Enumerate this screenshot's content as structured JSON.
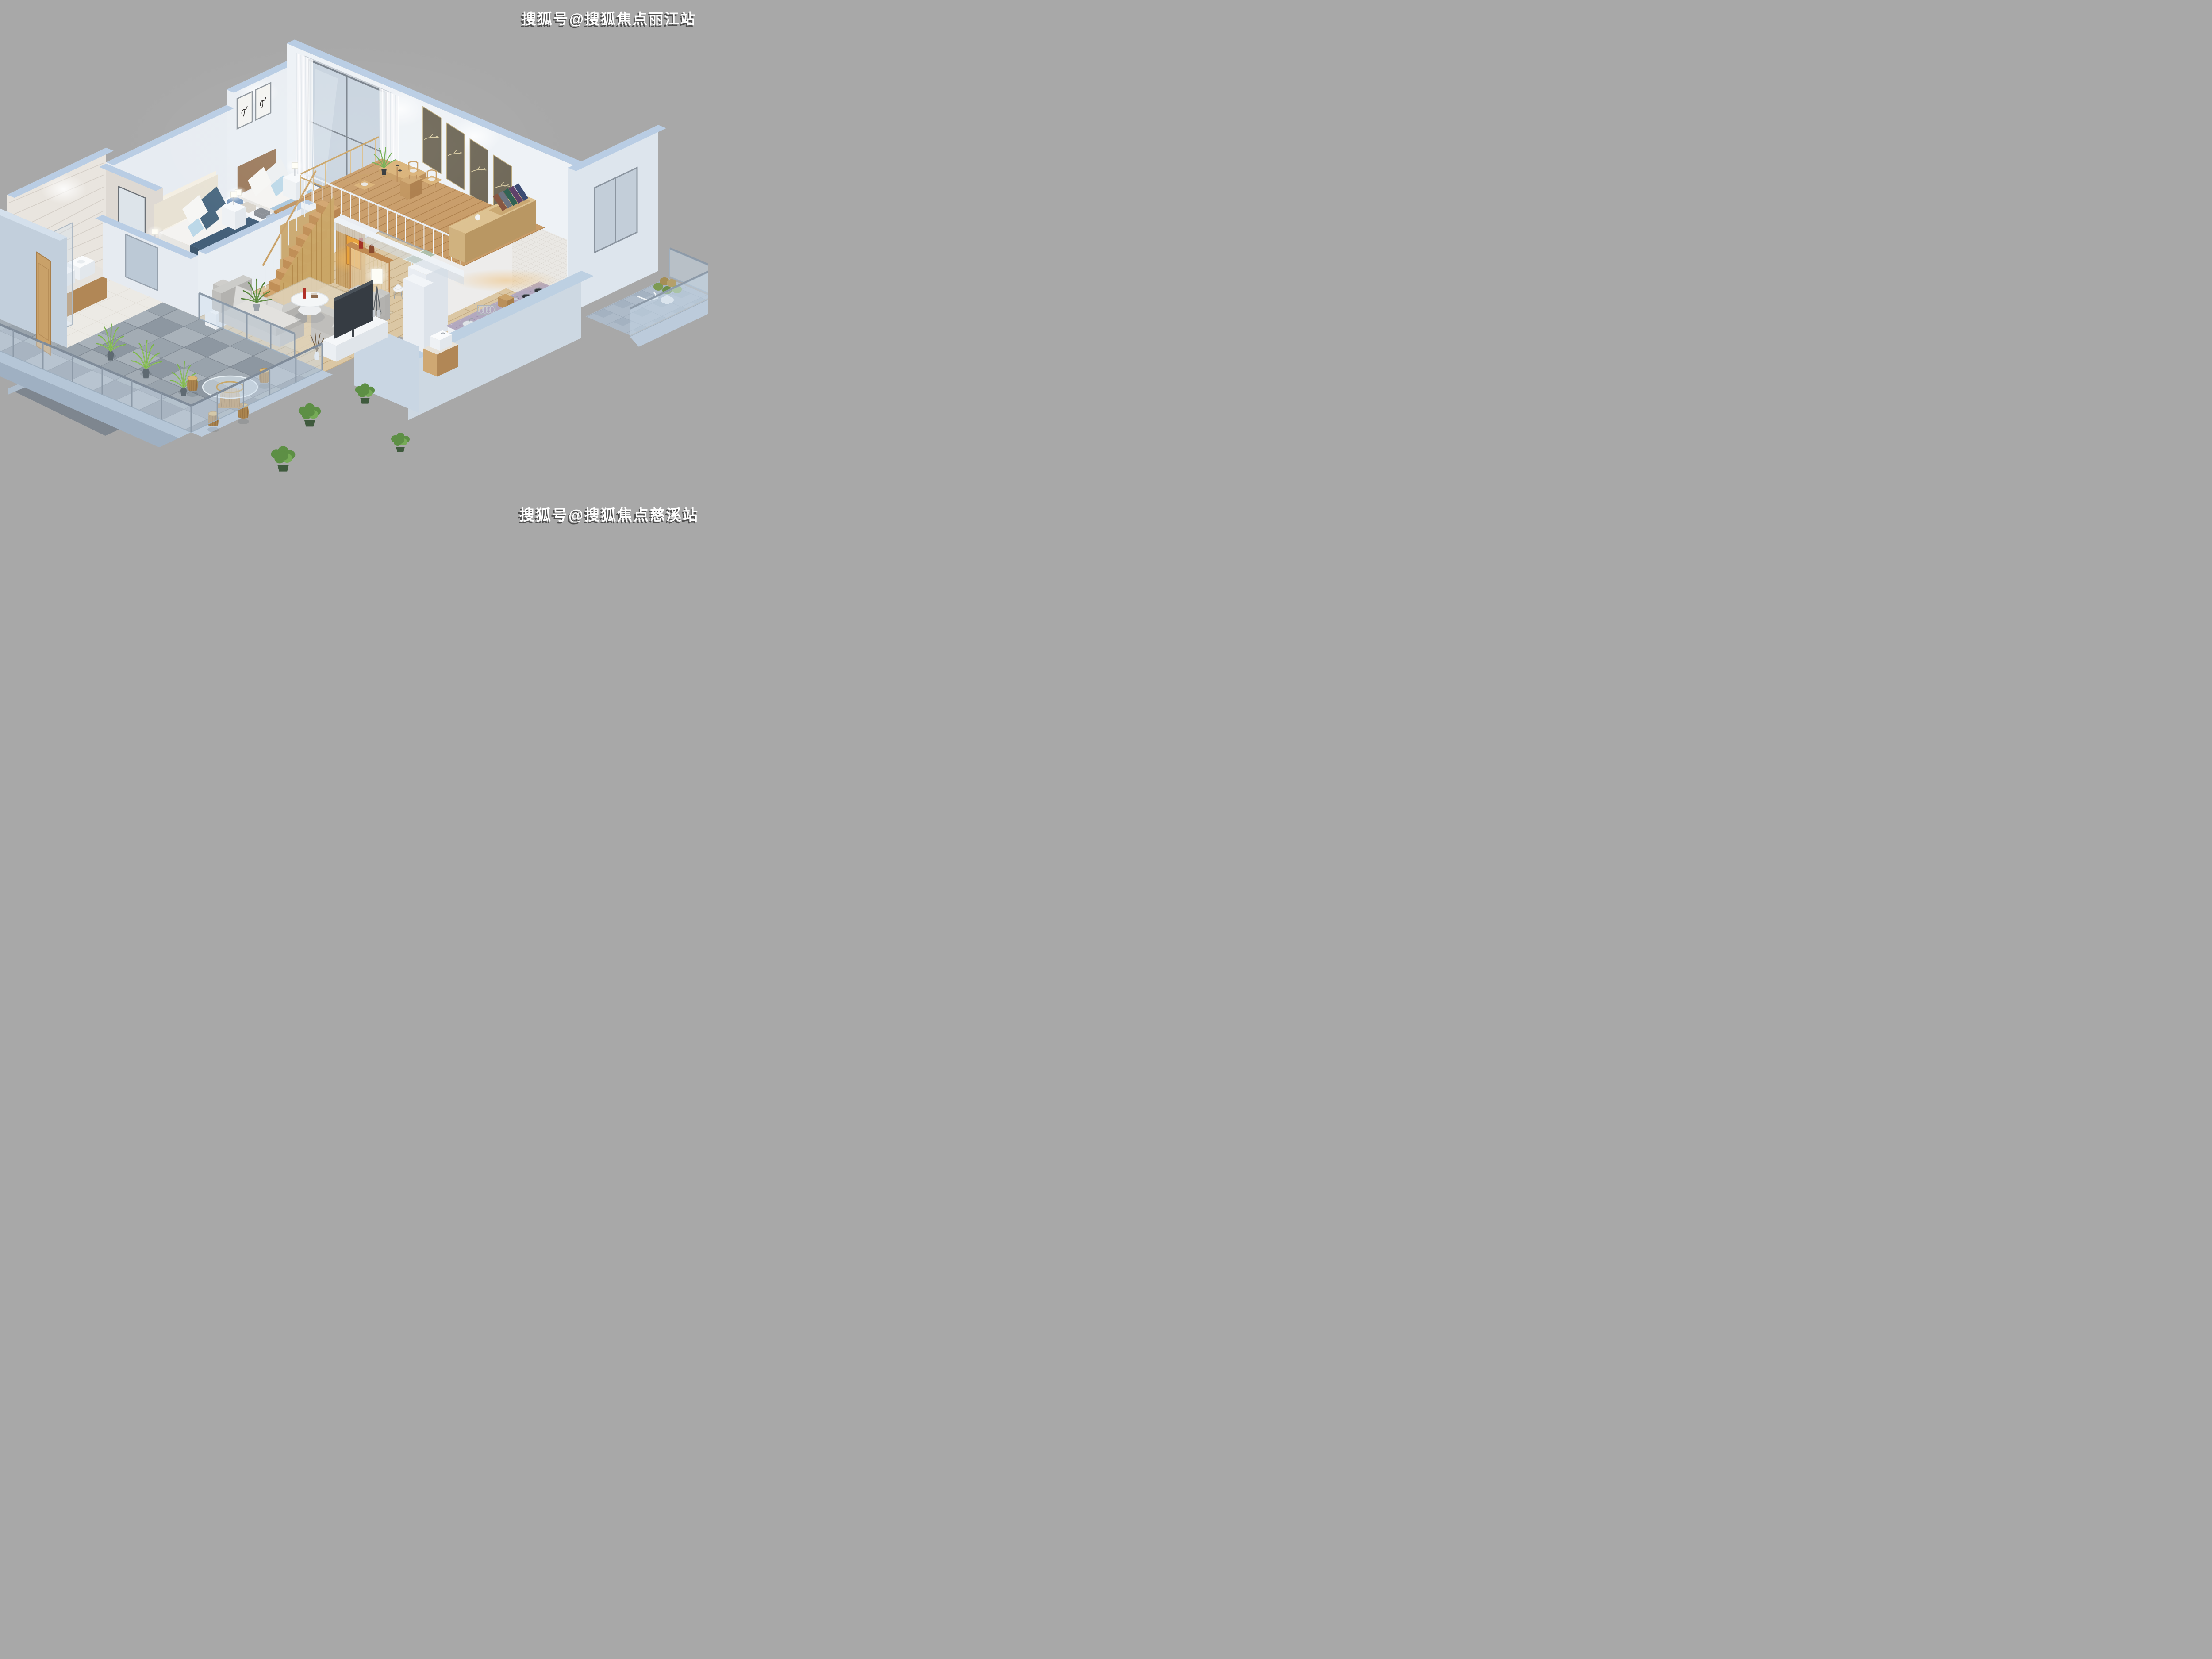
{
  "image_type": "3d-isometric-loft-apartment-cutaway-render",
  "watermarks": {
    "top_right": "搜狐号@搜狐焦点丽江站",
    "bottom_right": "搜狐号@搜狐焦点慈溪站"
  },
  "palette": {
    "background": "#a8a8a8",
    "cut_wall_rim": "#b9cde4",
    "wall_light": "#eef2f6",
    "wall_pale_blue": "#c2cfdc",
    "marble_wall": "#e9e5df",
    "wood_floor": "#dbc7a4",
    "mezzanine_wood": "#c89c68",
    "stair_wood": "#d2a56e",
    "terrace_tile": "#99a3ac",
    "granite_counter": "#b2a8bf",
    "sofa_gray": "#d4d3d0",
    "navy_bedding": "#44607a",
    "tan_bedding": "#bf9566",
    "plant_green": "#6da04c",
    "glass": "#cddeee",
    "warm_light": "#f0b45a",
    "tv_dark": "#363c43"
  },
  "scene": {
    "rooms": [
      "bathroom-with-shower",
      "master-bedroom",
      "second-bedroom",
      "living-room",
      "dining-area",
      "mezzanine-study",
      "kitchen-corridor",
      "guest-toilet",
      "front-terrace",
      "side-balcony"
    ],
    "furniture": [
      "double-bed-navy",
      "double-bed-tan",
      "twin-vessel-sink-vanity",
      "toilet",
      "shower-enclosure",
      "gray-sofa-three-seat",
      "gray-sofa-two-seat",
      "round-coffee-table",
      "tripod-floor-lamp",
      "tv-console",
      "wall-tv",
      "wooden-staircase",
      "golden-slat-screen",
      "glass-dining-table",
      "white-shell-chairs",
      "bar-stools",
      "study-desk",
      "low-bookshelf",
      "kitchen-counter-gas-hob",
      "dish-rack",
      "rattan-stool-set",
      "potted-palms",
      "glass-railings",
      "wooden-entry-door"
    ]
  }
}
